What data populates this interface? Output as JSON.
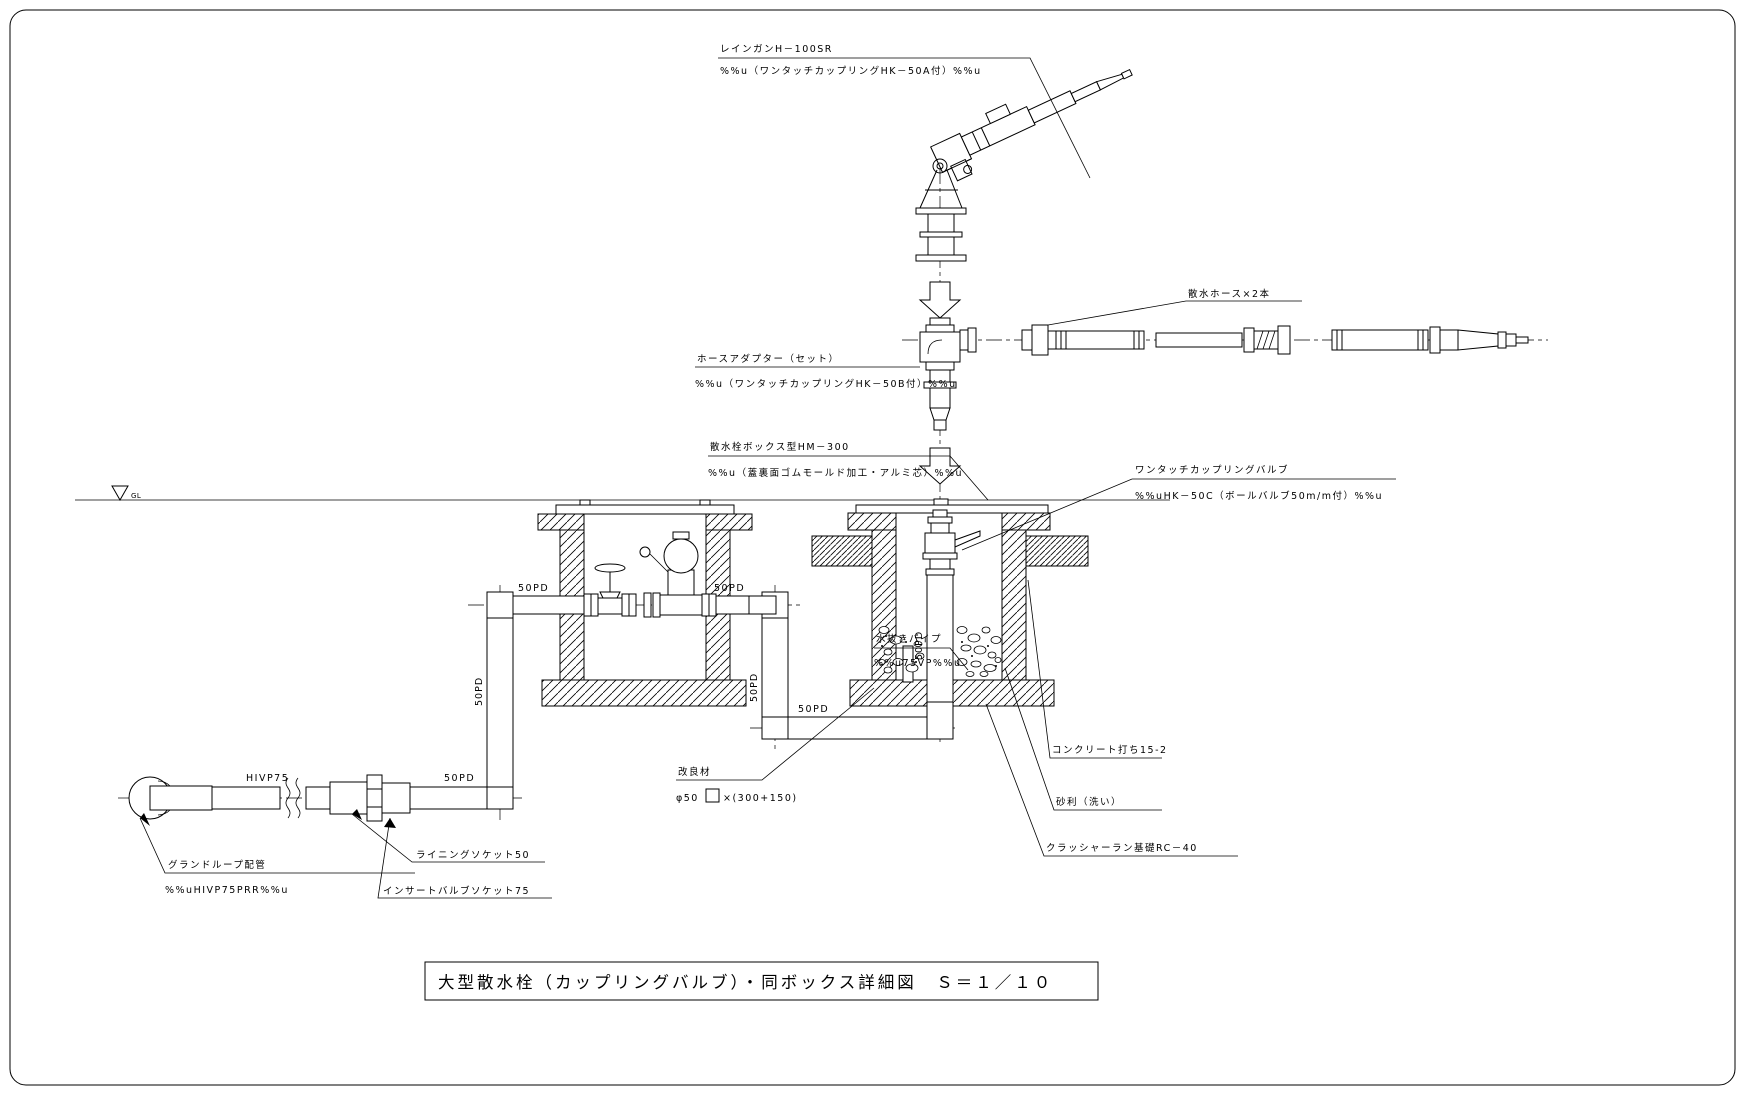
{
  "drawing": {
    "title": "大型散水栓（カップリングバルブ）・同ボックス詳細図　Ｓ＝１／１０",
    "gl_marker": "GL"
  },
  "callouts": {
    "rain_gun": {
      "line1": "レインガンH－100SR",
      "line2": "%%u（ワンタッチカップリングHK－50A付）%%u"
    },
    "hose": {
      "line1": "散水ホース×2本"
    },
    "hose_adapter": {
      "line1": "ホースアダプター（セット）",
      "line2": "%%u（ワンタッチカップリングHK－50B付）%%u"
    },
    "valve_box": {
      "line1": "散水栓ボックス型HM－300",
      "line2": "%%u（蓋裏面ゴムモールド加工・アルミ芯）%%u"
    },
    "coupling_valve": {
      "line1": "ワンタッチカップリングバルブ",
      "line2": "%%uHK－50C（ボールバルブ50m/m付）%%u"
    },
    "drain_pipe": {
      "line1": "水抜きパイプ",
      "line2": "%%u75VP%%u"
    },
    "ground_loop": {
      "line1": "グランドループ配管",
      "line2": "%%uHIVP75PRR%%u"
    },
    "lining_socket": {
      "line1": "ライニングソケット50"
    },
    "insert_socket": {
      "line1": "インサートバルブソケット75"
    },
    "improved_soil": {
      "line1": "改良材",
      "line2_prefix": "φ50",
      "line2_suffix": "×(300+150)"
    },
    "concrete": {
      "line1": "コンクリート打ち15-2"
    },
    "gravel": {
      "line1": "砂利（洗い）"
    },
    "crusher_run": {
      "line1": "クラッシャーラン基礎RC－40"
    }
  },
  "pipe_labels": {
    "hivp75": "HIVP75",
    "pd50": "50PD"
  }
}
